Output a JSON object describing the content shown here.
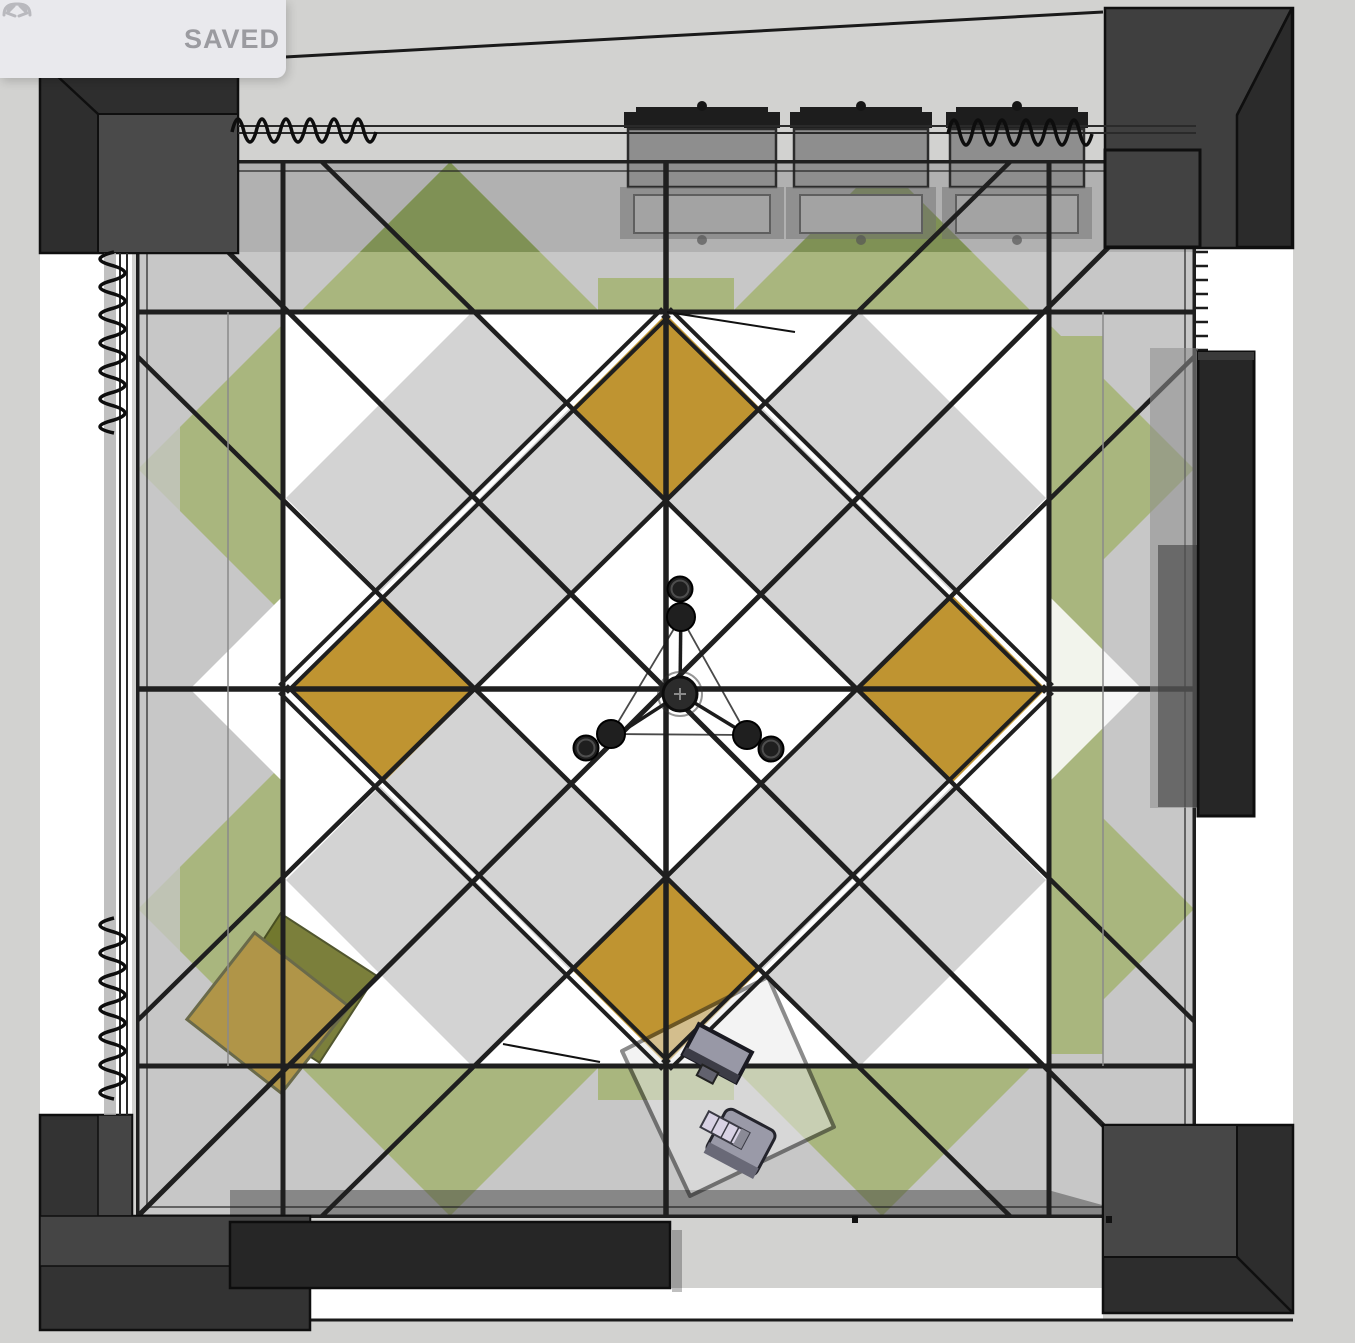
{
  "toolbar": {
    "saved_label": "SAVED",
    "undo_icon": "undo-arrow",
    "redo_icon": "redo-arrow"
  },
  "scene": {
    "view": "floor-plan-top-view",
    "objects": [
      "patterned-parquet-floor",
      "corner-walls",
      "window-curtain-top-left",
      "window-curtain-top-right",
      "window-curtain-left-upper",
      "window-curtain-left-lower",
      "wall-cabinet-1",
      "wall-cabinet-2",
      "wall-cabinet-3",
      "radiator-ticks",
      "wardrobe-right",
      "sideboard-bottom",
      "desk-with-monitor-keyboard-chair",
      "ottoman-gold",
      "ceiling-chandelier"
    ]
  },
  "colors": {
    "canvas_bg": "#d2d2d0",
    "floor_white": "#ffffff",
    "band_gray": "#c7c7c7",
    "band_gray_dark": "#b1b1b1",
    "cell_gray": "#d3d3d3",
    "green": "#a9b67e",
    "green_dark": "#7f9155",
    "gold": "#bf9431",
    "wall_outer": "#2e2e2e",
    "wall_inner": "#4a4a4a",
    "wall_right": "#3f3f3f",
    "line": "#1f1f1f",
    "furn_dark": "#262626",
    "cabinet_gray": "#8e8e8e",
    "shadow": "#3a3a3a",
    "toolbar_bg": "#e9e9ed",
    "toolbar_text": "#9b9ba0",
    "toolbar_icon": "#b9b9be",
    "desk": "#e8e8e8",
    "ottoman": "#b09548",
    "olive": "#6d7226",
    "curtain": "#0d0d0d"
  }
}
